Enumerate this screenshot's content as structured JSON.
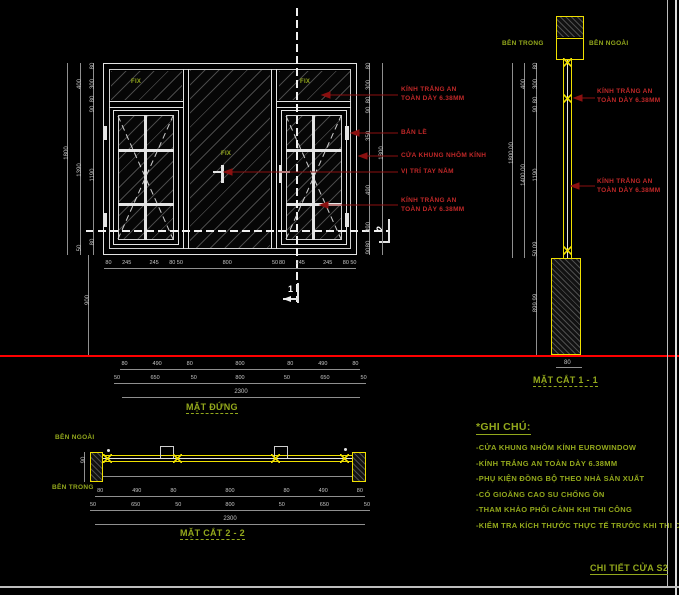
{
  "title_block": {
    "drawing_title": "CHI TIẾT CỬA  S2"
  },
  "elevation": {
    "view_label": "MẶT ĐỨNG",
    "fix_label": "FIX",
    "callouts": {
      "glass_top": "KÍNH TRẮNG AN TOÀN DÀY 6.38MM",
      "hinge": "BẢN LỀ",
      "frame": "CỬA KHUNG NHÔM KÍNH",
      "handle": "VỊ TRÍ TAY NẮM",
      "glass_bottom": "KÍNH TRẮNG AN TOÀN DÀY 6.38MM"
    },
    "dims": {
      "left_outer": "1800",
      "left_mid": [
        "400",
        "1390",
        "50"
      ],
      "left_inner": [
        "80",
        "300",
        "80",
        "90",
        "1190",
        "80"
      ],
      "right_outer": "1800",
      "right_inner": [
        "80",
        "300",
        "80",
        "90",
        "350",
        "490",
        "390",
        "80",
        "90"
      ],
      "bottom": [
        "80",
        "245",
        "245",
        "80",
        "50",
        "800",
        "50",
        "80",
        "245",
        "245",
        "80",
        "50"
      ],
      "base_height": "900"
    },
    "section_markers": {
      "vertical": "1",
      "horizontal": "2"
    }
  },
  "width_chain": {
    "row1": [
      "80",
      "490",
      "80",
      "800",
      "80",
      "490",
      "80"
    ],
    "row2": [
      "50",
      "650",
      "50",
      "800",
      "50",
      "650",
      "50"
    ],
    "total": "2300"
  },
  "section_1_1": {
    "view_label": "MẶT CẮT 1 - 1",
    "inside_label": "BÊN TRONG",
    "outside_label": "BÊN NGOÀI",
    "callouts": {
      "glass_top": "KÍNH TRẮNG AN TOÀN DÀY 6.38MM",
      "glass_bottom": "KÍNH TRẮNG AN TOÀN DÀY 6.38MM"
    },
    "dims": {
      "outer": "1800.00",
      "mid": [
        "400",
        "1400.00"
      ],
      "inner": [
        "80",
        "300",
        "80",
        "90",
        "1190"
      ],
      "sill": [
        "50.09",
        "899.99"
      ],
      "base_width": "80"
    }
  },
  "section_2_2": {
    "view_label": "MẶT CẮT 2 - 2",
    "outside_label": "BÊN NGOÀI",
    "inside_label": "BÊN TRONG",
    "dims": {
      "depth": "90"
    }
  },
  "notes": {
    "title": "*GHI CHÚ:",
    "items": [
      "-CỬA KHUNG NHÔM KÍNH EUROWINDOW",
      "-KÍNH TRẮNG AN TOÀN DÀY 6.38MM",
      "-PHỤ KIỆN ĐỒNG BỘ THEO NHÀ SẢN XUẤT",
      "-CÓ GIOĂNG CAO SU CHỐNG ỒN",
      "-THAM KHẢO PHỐI CẢNH KHI THI CÔNG",
      "-KIỂM TRA KÍCH THƯỚC THỰC TẾ TRƯỚC KHI THI CÔNG"
    ]
  },
  "colors": {
    "background": "#000000",
    "frame_yellow": "#f0e000",
    "annotation_green": "#93a81c",
    "label_red": "#c02828",
    "leader_red": "#8b1010",
    "ground_line_red": "#ff0000",
    "drawing_white": "#e4e4e4"
  }
}
